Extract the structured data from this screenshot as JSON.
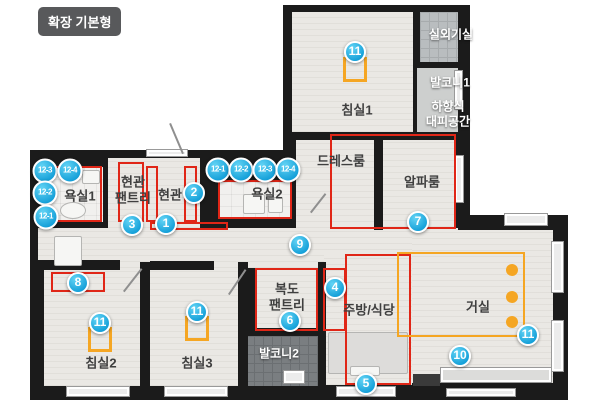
{
  "title": "확장 기본형",
  "rooms": {
    "bedroom1": "침실1",
    "outdoor_unit": "실외기실",
    "balcony1": "발코니1",
    "evac_line1": "하향식",
    "evac_line2": "대피공간",
    "dressroom": "드레스룸",
    "alpha_room": "알파룸",
    "bathroom1": "욕실1",
    "entrance_pantry_line1": "현관",
    "entrance_pantry_line2": "팬트리",
    "entrance": "현관",
    "bathroom2": "욕실2",
    "corridor_pantry_line1": "복도",
    "corridor_pantry_line2": "팬트리",
    "kitchen": "주방/식당",
    "living": "거실",
    "balcony2": "발코니2",
    "bedroom2": "침실2",
    "bedroom3": "침실3"
  },
  "badges": {
    "n1": "1",
    "n2": "2",
    "n3": "3",
    "n4": "4",
    "n5": "5",
    "n6": "6",
    "n7": "7",
    "n8": "8",
    "n9": "9",
    "n10": "10",
    "n11": "11",
    "n12_1": "12-1",
    "n12_2": "12-2",
    "n12_3": "12-3",
    "n12_4": "12-4"
  },
  "colors": {
    "badge_blue": "#1cb0e6",
    "outline_red": "#e02617",
    "furniture_orange": "#f5a623",
    "wall_black": "#1b1b1b"
  }
}
